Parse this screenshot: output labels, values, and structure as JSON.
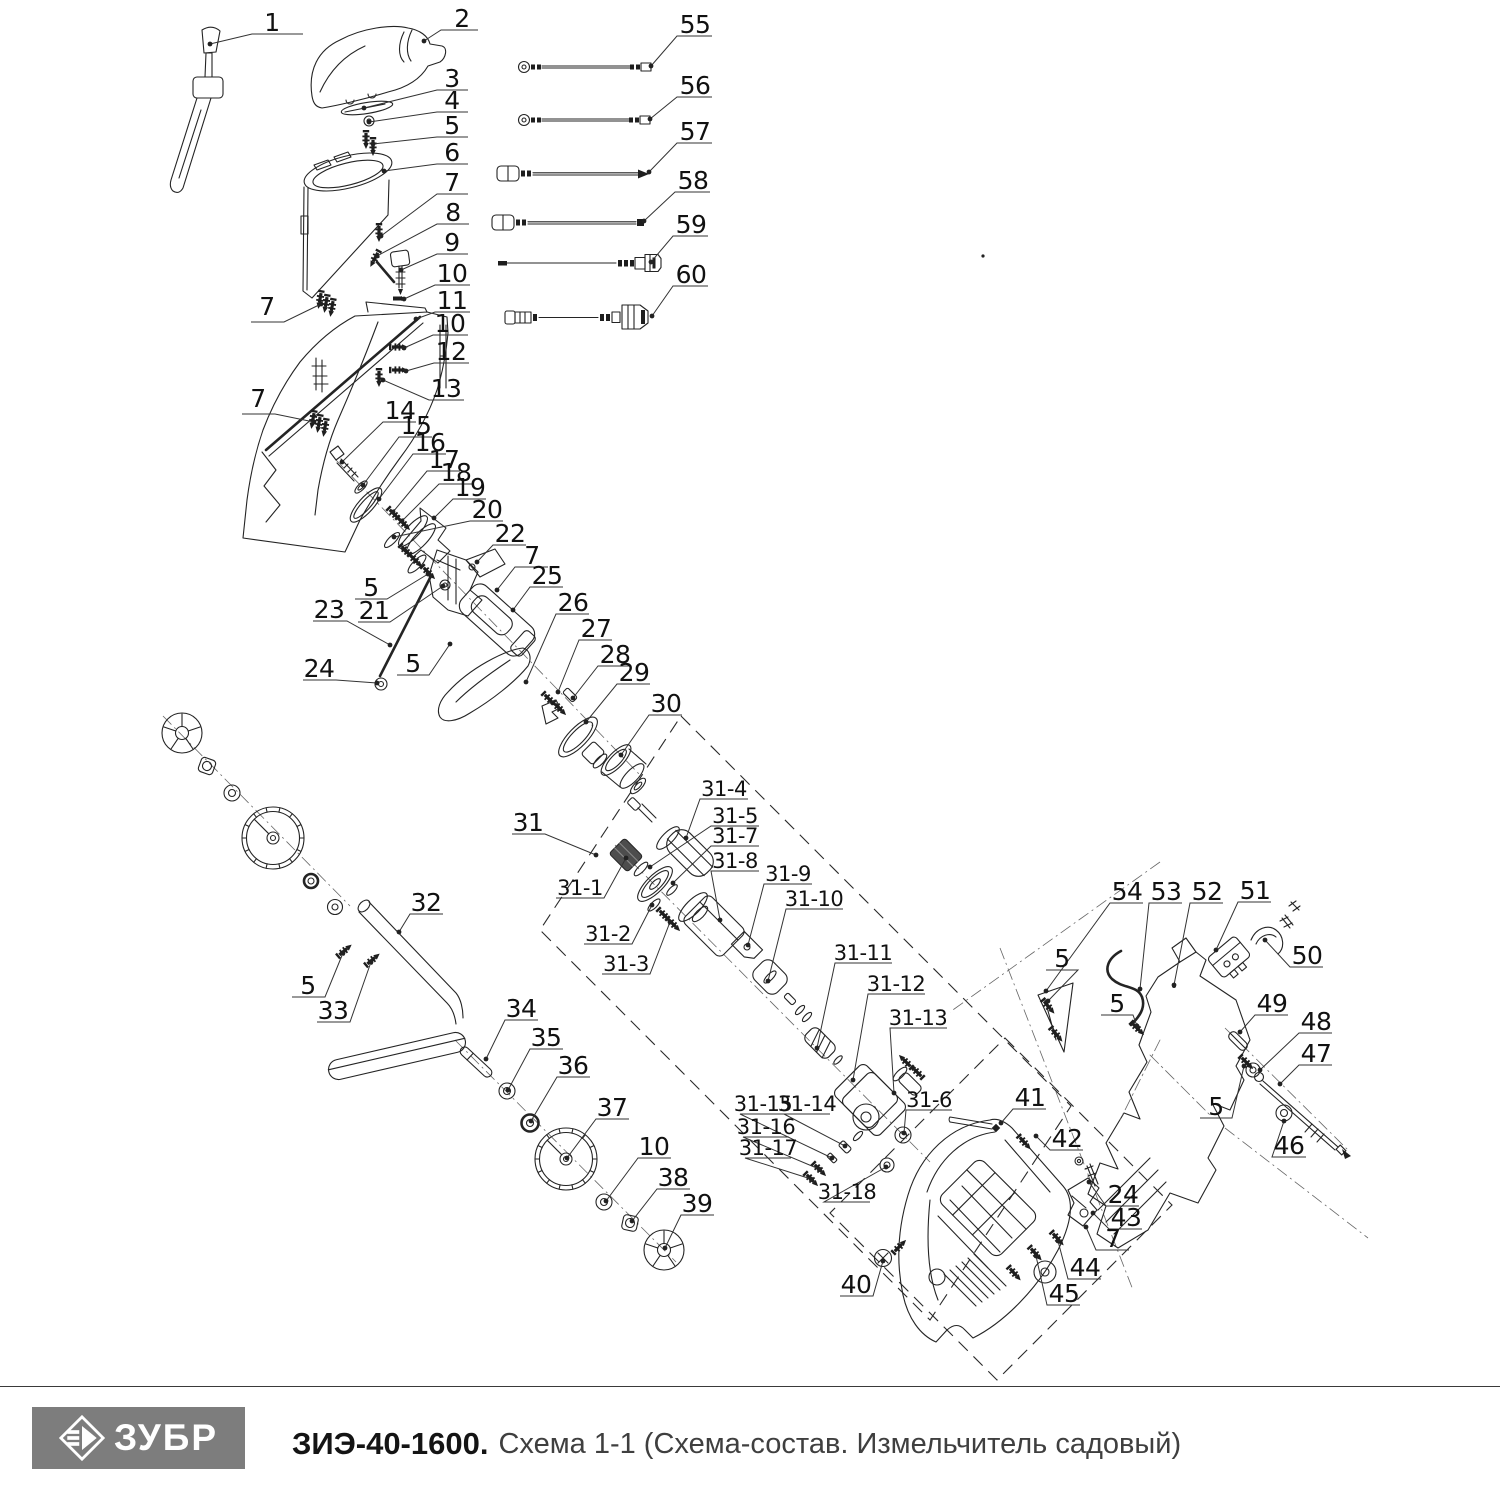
{
  "footer": {
    "logo_text": "ЗУБР",
    "model": "ЗИЭ-40-1600.",
    "subtitle": "Схема 1-1 (Схема-состав. Измельчитель садовый)"
  },
  "diagram": {
    "labels": [
      {
        "t": "1",
        "x": 272,
        "y": 31,
        "lead": [
          303,
          34,
          252,
          34,
          210,
          44
        ]
      },
      {
        "t": "2",
        "x": 462,
        "y": 27,
        "lead": [
          478,
          30,
          441,
          30,
          424,
          41
        ]
      },
      {
        "t": "3",
        "x": 452,
        "y": 87,
        "lead": [
          468,
          90,
          437,
          90,
          364,
          108
        ]
      },
      {
        "t": "4",
        "x": 452,
        "y": 109,
        "lead": [
          468,
          112,
          437,
          112,
          369,
          122
        ]
      },
      {
        "t": "5",
        "x": 452,
        "y": 134,
        "lead": [
          468,
          137,
          437,
          137,
          373,
          144
        ]
      },
      {
        "t": "6",
        "x": 452,
        "y": 161,
        "lead": [
          468,
          164,
          437,
          164,
          384,
          171
        ]
      },
      {
        "t": "7",
        "x": 452,
        "y": 191,
        "lead": [
          468,
          194,
          437,
          194,
          381,
          236
        ]
      },
      {
        "t": "8",
        "x": 453,
        "y": 221,
        "lead": [
          469,
          224,
          437,
          224,
          377,
          256
        ]
      },
      {
        "t": "9",
        "x": 452,
        "y": 251,
        "lead": [
          468,
          254,
          437,
          254,
          401,
          270
        ]
      },
      {
        "t": "10",
        "x": 452,
        "y": 282,
        "lead": [
          470,
          285,
          435,
          285,
          404,
          299
        ]
      },
      {
        "t": "11",
        "x": 452,
        "y": 309,
        "lead": [
          470,
          312,
          435,
          312,
          416,
          319
        ]
      },
      {
        "t": "10",
        "x": 450,
        "y": 332,
        "lead": [
          468,
          335,
          433,
          335,
          404,
          348
        ]
      },
      {
        "t": "12",
        "x": 451,
        "y": 360,
        "lead": [
          469,
          363,
          434,
          363,
          406,
          371
        ]
      },
      {
        "t": "13",
        "x": 446,
        "y": 397,
        "lead": [
          464,
          400,
          429,
          400,
          383,
          380
        ]
      },
      {
        "t": "7",
        "x": 267,
        "y": 315,
        "lead": [
          251,
          322,
          284,
          322,
          321,
          304
        ]
      },
      {
        "t": "7",
        "x": 258,
        "y": 407,
        "lead": [
          242,
          414,
          275,
          414,
          314,
          422
        ]
      },
      {
        "t": "55",
        "x": 695,
        "y": 33,
        "lead": [
          712,
          36,
          677,
          36,
          651,
          66
        ]
      },
      {
        "t": "56",
        "x": 695,
        "y": 94,
        "lead": [
          712,
          97,
          677,
          97,
          650,
          119
        ]
      },
      {
        "t": "57",
        "x": 695,
        "y": 140,
        "lead": [
          712,
          143,
          677,
          143,
          649,
          172
        ]
      },
      {
        "t": "58",
        "x": 693,
        "y": 189,
        "lead": [
          710,
          192,
          675,
          192,
          644,
          221
        ]
      },
      {
        "t": "59",
        "x": 691,
        "y": 233,
        "lead": [
          708,
          236,
          673,
          236,
          651,
          262
        ]
      },
      {
        "t": "60",
        "x": 691,
        "y": 283,
        "lead": [
          708,
          286,
          673,
          286,
          652,
          316
        ]
      },
      {
        "t": "14",
        "x": 400,
        "y": 419,
        "lead": [
          416,
          422,
          383,
          422,
          342,
          462
        ]
      },
      {
        "t": "15",
        "x": 416,
        "y": 434,
        "lead": [
          432,
          437,
          399,
          437,
          363,
          485
        ]
      },
      {
        "t": "16",
        "x": 430,
        "y": 451,
        "lead": [
          446,
          454,
          413,
          454,
          379,
          499
        ]
      },
      {
        "t": "17",
        "x": 444,
        "y": 468,
        "lead": [
          460,
          471,
          427,
          471,
          393,
          512
        ]
      },
      {
        "t": "18",
        "x": 456,
        "y": 481,
        "lead": [
          472,
          484,
          439,
          484,
          402,
          521
        ]
      },
      {
        "t": "19",
        "x": 470,
        "y": 496,
        "lead": [
          486,
          499,
          453,
          499,
          434,
          518
        ]
      },
      {
        "t": "20",
        "x": 487,
        "y": 518,
        "lead": [
          503,
          521,
          470,
          521,
          394,
          537
        ]
      },
      {
        "t": "22",
        "x": 510,
        "y": 542,
        "lead": [
          526,
          545,
          493,
          545,
          477,
          562
        ]
      },
      {
        "t": "7",
        "x": 532,
        "y": 564,
        "lead": [
          548,
          567,
          515,
          567,
          497,
          590
        ]
      },
      {
        "t": "25",
        "x": 547,
        "y": 584,
        "lead": [
          563,
          587,
          530,
          587,
          513,
          610
        ]
      },
      {
        "t": "26",
        "x": 573,
        "y": 611,
        "lead": [
          589,
          614,
          556,
          614,
          526,
          682
        ]
      },
      {
        "t": "27",
        "x": 596,
        "y": 637,
        "lead": [
          612,
          640,
          579,
          640,
          558,
          692
        ]
      },
      {
        "t": "28",
        "x": 615,
        "y": 663,
        "lead": [
          631,
          666,
          598,
          666,
          573,
          698
        ]
      },
      {
        "t": "29",
        "x": 634,
        "y": 681,
        "lead": [
          650,
          684,
          617,
          684,
          586,
          722
        ]
      },
      {
        "t": "30",
        "x": 666,
        "y": 712,
        "lead": [
          682,
          715,
          649,
          715,
          621,
          755
        ]
      },
      {
        "t": "5",
        "x": 371,
        "y": 596,
        "lead": [
          355,
          599,
          387,
          599,
          428,
          574
        ]
      },
      {
        "t": "21",
        "x": 374,
        "y": 619,
        "lead": [
          358,
          622,
          390,
          622,
          443,
          586
        ]
      },
      {
        "t": "23",
        "x": 329,
        "y": 618,
        "lead": [
          313,
          621,
          347,
          621,
          390,
          645
        ]
      },
      {
        "t": "24",
        "x": 319,
        "y": 677,
        "lead": [
          303,
          680,
          336,
          680,
          377,
          683
        ]
      },
      {
        "t": "5",
        "x": 413,
        "y": 672,
        "lead": [
          397,
          675,
          429,
          675,
          450,
          644
        ]
      },
      {
        "t": "31",
        "x": 528,
        "y": 831,
        "lead": [
          512,
          834,
          545,
          834,
          596,
          855
        ]
      },
      {
        "t": "31-1",
        "x": 580,
        "y": 895,
        "lead": [
          556,
          898,
          604,
          898,
          626,
          858
        ]
      },
      {
        "t": "31-2",
        "x": 608,
        "y": 941,
        "lead": [
          584,
          944,
          632,
          944,
          652,
          905
        ]
      },
      {
        "t": "31-3",
        "x": 626,
        "y": 971,
        "lead": [
          602,
          974,
          650,
          974,
          670,
          922
        ]
      },
      {
        "t": "31-4",
        "x": 724,
        "y": 796,
        "lead": [
          748,
          799,
          700,
          799,
          686,
          838
        ]
      },
      {
        "t": "31-5",
        "x": 735,
        "y": 823,
        "lead": [
          759,
          826,
          711,
          826,
          650,
          867
        ]
      },
      {
        "t": "31-7",
        "x": 735,
        "y": 843,
        "lead": [
          759,
          846,
          711,
          846,
          673,
          883
        ]
      },
      {
        "t": "31-8",
        "x": 735,
        "y": 868,
        "lead": [
          759,
          871,
          711,
          871,
          720,
          920
        ]
      },
      {
        "t": "31-9",
        "x": 788,
        "y": 881,
        "lead": [
          812,
          884,
          764,
          884,
          748,
          945
        ]
      },
      {
        "t": "31-10",
        "x": 814,
        "y": 906,
        "lead": [
          843,
          909,
          786,
          909,
          768,
          981
        ]
      },
      {
        "t": "31-11",
        "x": 863,
        "y": 960,
        "lead": [
          892,
          963,
          835,
          963,
          817,
          1048
        ]
      },
      {
        "t": "31-12",
        "x": 896,
        "y": 991,
        "lead": [
          925,
          994,
          868,
          994,
          853,
          1080
        ]
      },
      {
        "t": "31-13",
        "x": 918,
        "y": 1025,
        "lead": [
          947,
          1028,
          890,
          1028,
          894,
          1093
        ]
      },
      {
        "t": "31-15",
        "x": 763,
        "y": 1111,
        "lead": [
          786,
          1114,
          740,
          1114,
          832,
          1158
        ]
      },
      {
        "t": "31-14",
        "x": 807,
        "y": 1111,
        "lead": [
          830,
          1114,
          784,
          1114,
          845,
          1146
        ]
      },
      {
        "t": "31-16",
        "x": 766,
        "y": 1134,
        "lead": [
          789,
          1137,
          743,
          1137,
          819,
          1169
        ]
      },
      {
        "t": "31-17",
        "x": 768,
        "y": 1155,
        "lead": [
          791,
          1158,
          745,
          1158,
          811,
          1179
        ]
      },
      {
        "t": "31-18",
        "x": 847,
        "y": 1199,
        "lead": [
          870,
          1202,
          824,
          1202,
          886,
          1167
        ]
      },
      {
        "t": "31-6",
        "x": 929,
        "y": 1107,
        "lead": [
          952,
          1110,
          906,
          1110,
          904,
          1133
        ]
      },
      {
        "t": "32",
        "x": 426,
        "y": 911,
        "lead": [
          443,
          914,
          410,
          914,
          399,
          932
        ]
      },
      {
        "t": "5",
        "x": 308,
        "y": 994,
        "lead": [
          292,
          997,
          325,
          997,
          343,
          953
        ]
      },
      {
        "t": "33",
        "x": 333,
        "y": 1019,
        "lead": [
          317,
          1022,
          350,
          1022,
          371,
          962
        ]
      },
      {
        "t": "34",
        "x": 521,
        "y": 1017,
        "lead": [
          538,
          1020,
          505,
          1020,
          486,
          1059
        ]
      },
      {
        "t": "35",
        "x": 546,
        "y": 1046,
        "lead": [
          563,
          1049,
          530,
          1049,
          508,
          1090
        ]
      },
      {
        "t": "36",
        "x": 573,
        "y": 1074,
        "lead": [
          590,
          1077,
          557,
          1077,
          531,
          1121
        ]
      },
      {
        "t": "37",
        "x": 612,
        "y": 1116,
        "lead": [
          629,
          1119,
          596,
          1119,
          567,
          1158
        ]
      },
      {
        "t": "10",
        "x": 654,
        "y": 1155,
        "lead": [
          671,
          1158,
          638,
          1158,
          606,
          1201
        ]
      },
      {
        "t": "38",
        "x": 673,
        "y": 1186,
        "lead": [
          690,
          1189,
          657,
          1189,
          632,
          1221
        ]
      },
      {
        "t": "39",
        "x": 697,
        "y": 1212,
        "lead": [
          714,
          1215,
          681,
          1215,
          665,
          1248
        ]
      },
      {
        "t": "40",
        "x": 856,
        "y": 1293,
        "lead": [
          840,
          1296,
          873,
          1296,
          883,
          1261
        ]
      },
      {
        "t": "41",
        "x": 1030,
        "y": 1106,
        "lead": [
          1046,
          1109,
          1013,
          1109,
          1001,
          1123
        ]
      },
      {
        "t": "42",
        "x": 1067,
        "y": 1147,
        "lead": [
          1083,
          1150,
          1050,
          1150,
          1036,
          1136
        ]
      },
      {
        "t": "24",
        "x": 1123,
        "y": 1203,
        "lead": [
          1139,
          1206,
          1106,
          1206,
          1089,
          1182
        ]
      },
      {
        "t": "43",
        "x": 1126,
        "y": 1226,
        "lead": [
          1142,
          1229,
          1109,
          1229,
          1093,
          1213
        ]
      },
      {
        "t": "7",
        "x": 1113,
        "y": 1247,
        "lead": [
          1129,
          1250,
          1096,
          1250,
          1086,
          1227
        ]
      },
      {
        "t": "44",
        "x": 1085,
        "y": 1276,
        "lead": [
          1101,
          1279,
          1068,
          1279,
          1058,
          1241
        ]
      },
      {
        "t": "45",
        "x": 1064,
        "y": 1302,
        "lead": [
          1080,
          1305,
          1047,
          1305,
          1036,
          1256
        ]
      },
      {
        "t": "54",
        "x": 1127,
        "y": 900,
        "lead": [
          1143,
          903,
          1110,
          903,
          1046,
          991
        ]
      },
      {
        "t": "53",
        "x": 1166,
        "y": 900,
        "lead": [
          1182,
          903,
          1149,
          903,
          1140,
          989
        ]
      },
      {
        "t": "52",
        "x": 1207,
        "y": 900,
        "lead": [
          1223,
          903,
          1190,
          903,
          1174,
          985
        ]
      },
      {
        "t": "51",
        "x": 1255,
        "y": 899,
        "lead": [
          1271,
          902,
          1238,
          902,
          1216,
          950
        ]
      },
      {
        "t": "50",
        "x": 1307,
        "y": 964,
        "lead": [
          1323,
          967,
          1290,
          967,
          1265,
          940
        ]
      },
      {
        "t": "49",
        "x": 1272,
        "y": 1012,
        "lead": [
          1288,
          1015,
          1255,
          1015,
          1240,
          1032
        ]
      },
      {
        "t": "48",
        "x": 1316,
        "y": 1030,
        "lead": [
          1332,
          1033,
          1299,
          1033,
          1260,
          1070
        ]
      },
      {
        "t": "47",
        "x": 1316,
        "y": 1062,
        "lead": [
          1332,
          1065,
          1299,
          1065,
          1280,
          1084
        ]
      },
      {
        "t": "46",
        "x": 1289,
        "y": 1154,
        "lead": [
          1306,
          1157,
          1272,
          1157,
          1284,
          1121
        ]
      },
      {
        "t": "5",
        "x": 1062,
        "y": 967,
        "lead": [
          1046,
          970,
          1078,
          970,
          1048,
          1001
        ]
      },
      {
        "t": "5",
        "x": 1117,
        "y": 1012,
        "lead": [
          1101,
          1015,
          1133,
          1015,
          1137,
          1026
        ]
      },
      {
        "t": "5",
        "x": 1216,
        "y": 1115,
        "lead": [
          1200,
          1118,
          1232,
          1118,
          1244,
          1066
        ]
      }
    ]
  }
}
